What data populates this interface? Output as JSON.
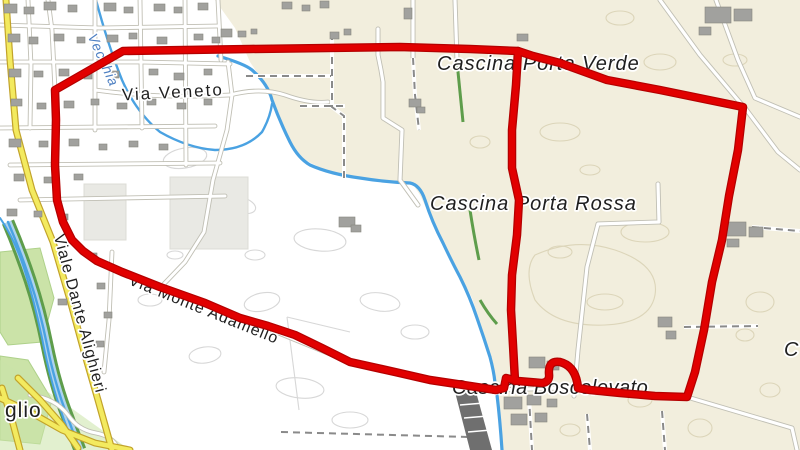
{
  "map": {
    "place_labels": {
      "cascina_porta_verde": "Cascina Porta Verde",
      "cascina_porta_rossa": "Cascina Porta Rossa",
      "cascina_boscolevato": "Cascina Boscolevato",
      "cascina_partial_right": "C",
      "town_partial": "glio"
    },
    "street_labels": {
      "via_veneto": "Via Veneto",
      "viale_dante_alighieri": "Viale Dante Alighieri",
      "via_monte_adamello": "Via Monte Adamello"
    },
    "waterway_label": "Vecchia",
    "colors": {
      "route_fill": "#e10000",
      "route_casing": "#b40000",
      "farmland": "#f2eedd",
      "field": "#ffffff",
      "water": "#4aa2e2",
      "water_light": "#aed3ee",
      "road_yellow": "#f3ea5f",
      "road_yellow_casing": "#c2a32a",
      "greenery": "#5e9d4b",
      "park": "#cbe3a8",
      "building": "#a1a19e"
    }
  }
}
